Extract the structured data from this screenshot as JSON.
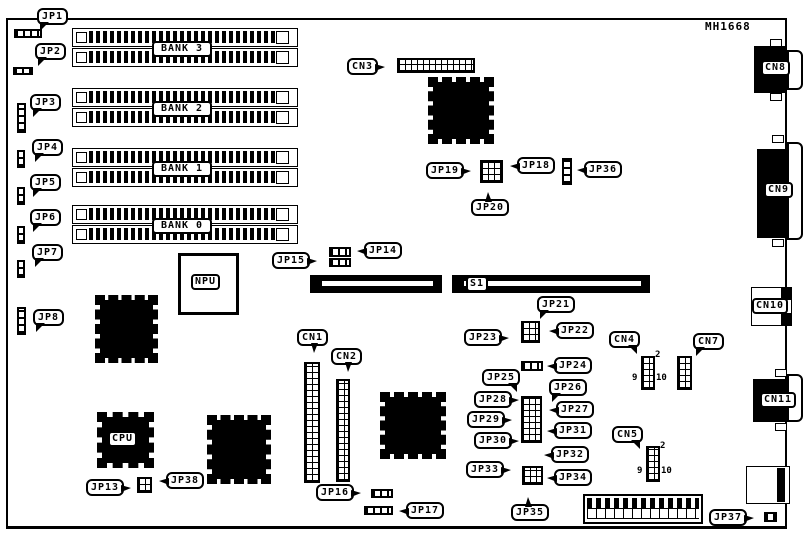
{
  "board": {
    "part_number": "MH1668"
  },
  "labels": {
    "jp1": "JP1",
    "jp2": "JP2",
    "jp3": "JP3",
    "jp4": "JP4",
    "jp5": "JP5",
    "jp6": "JP6",
    "jp7": "JP7",
    "jp8": "JP8",
    "jp13": "JP13",
    "jp14": "JP14",
    "jp15": "JP15",
    "jp16": "JP16",
    "jp17": "JP17",
    "jp18": "JP18",
    "jp19": "JP19",
    "jp20": "JP20",
    "jp21": "JP21",
    "jp22": "JP22",
    "jp23": "JP23",
    "jp24": "JP24",
    "jp25": "JP25",
    "jp26": "JP26",
    "jp27": "JP27",
    "jp28": "JP28",
    "jp29": "JP29",
    "jp30": "JP30",
    "jp31": "JP31",
    "jp32": "JP32",
    "jp33": "JP33",
    "jp34": "JP34",
    "jp35": "JP35",
    "jp36": "JP36",
    "jp37": "JP37",
    "jp38": "JP38",
    "cn1": "CN1",
    "cn2": "CN2",
    "cn3": "CN3",
    "cn4": "CN4",
    "cn5": "CN5",
    "cn7": "CN7",
    "cn8": "CN8",
    "cn9": "CN9",
    "cn10": "CN10",
    "cn11": "CN11",
    "bank3": "BANK 3",
    "bank2": "BANK 2",
    "bank1": "BANK 1",
    "bank0": "BANK 0",
    "npu": "NPU",
    "cpu": "CPU",
    "s1": "S1"
  },
  "pin_numbers": {
    "pin2": "2",
    "pin9": "9",
    "pin10": "10"
  },
  "colors": {
    "ink": "#000000",
    "paper": "#ffffff"
  }
}
